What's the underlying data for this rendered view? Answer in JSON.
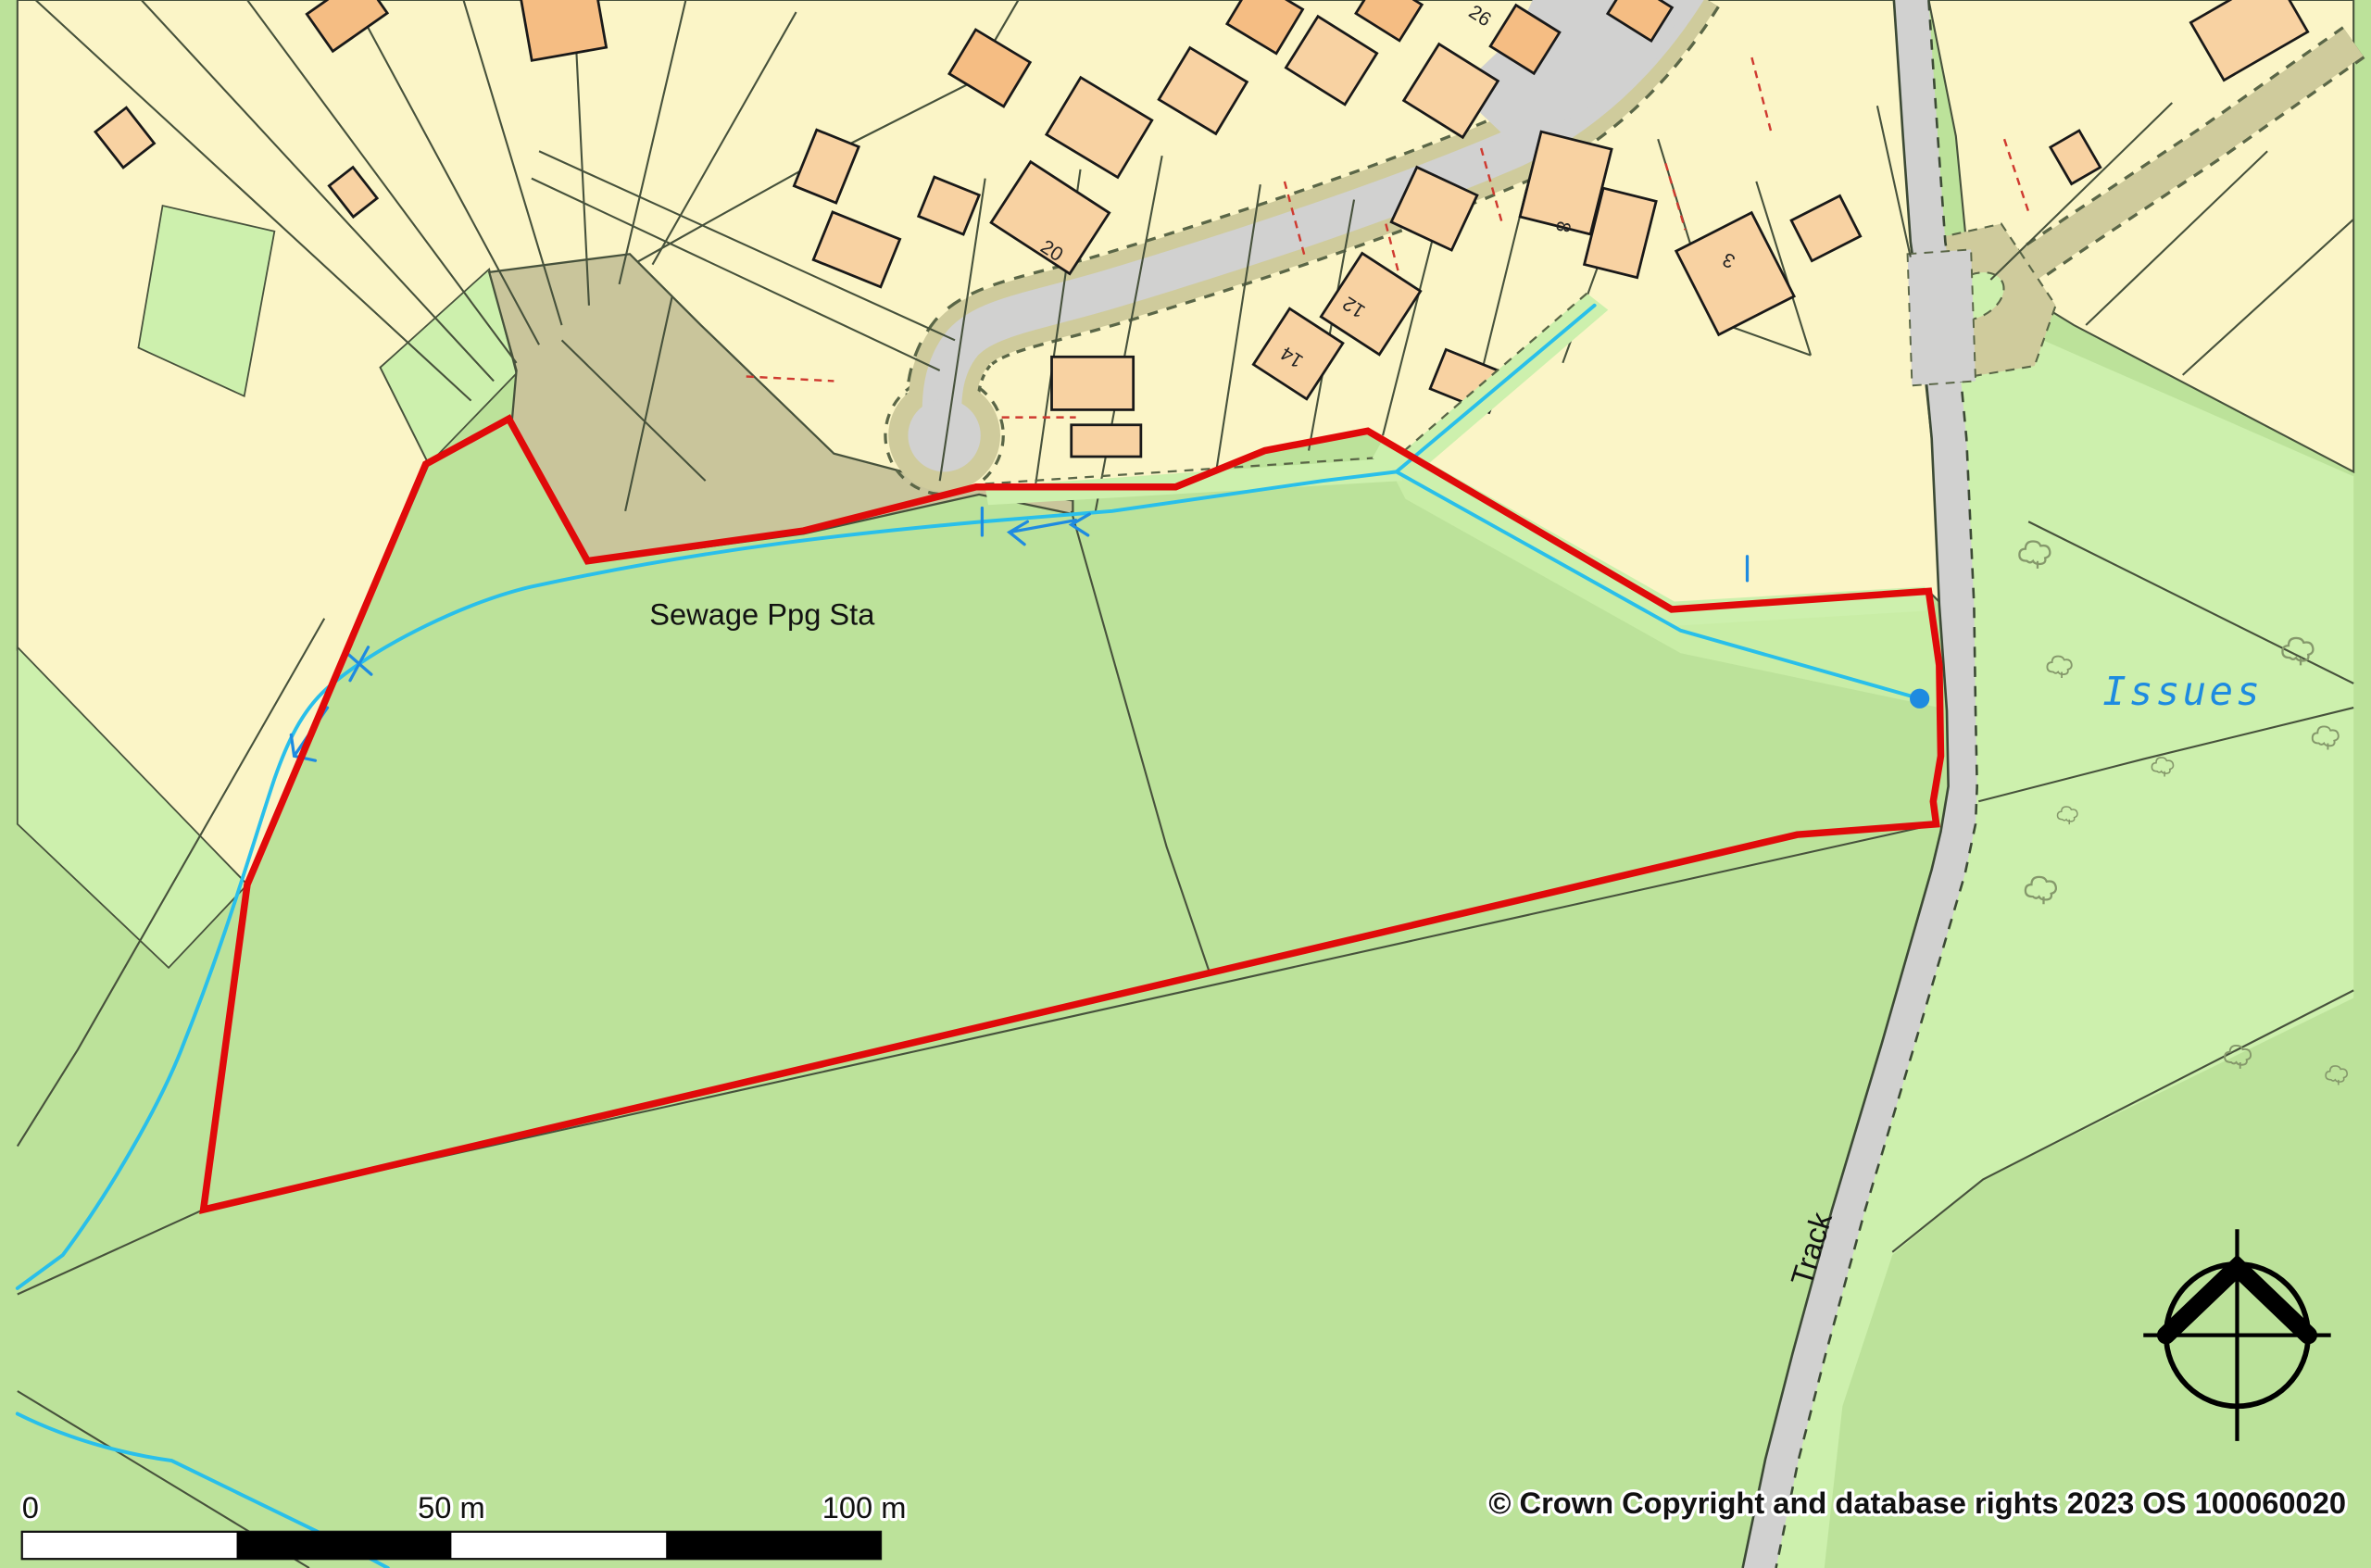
{
  "map": {
    "labels": {
      "sewage_station": "Sewage Ppg Sta",
      "water": "Issues",
      "track": "Track"
    },
    "house_numbers": {
      "h26": "26",
      "h20": "20",
      "h14": "14",
      "h12": "12",
      "h8": "8",
      "h3": "3"
    },
    "scale_bar": {
      "zero": "0",
      "fifty": "50 m",
      "hundred": "100 m"
    },
    "attribution": "© Crown Copyright and database rights 2023 OS 100060020",
    "palette": {
      "site_boundary_red": "#e00a0a",
      "stream_cyan": "#29bfea",
      "water_label_blue": "#1e8be0",
      "field_green": "#bce29a",
      "light_green": "#cdf0ad",
      "parcel_yellow": "#fbf5c7",
      "building_orange_light": "#f8d2a2",
      "building_orange_dark": "#f5bd83",
      "road_grey": "#d1d1d0",
      "verge_tan": "#cfcb9c",
      "compound_khaki": "#c9c59b"
    }
  }
}
